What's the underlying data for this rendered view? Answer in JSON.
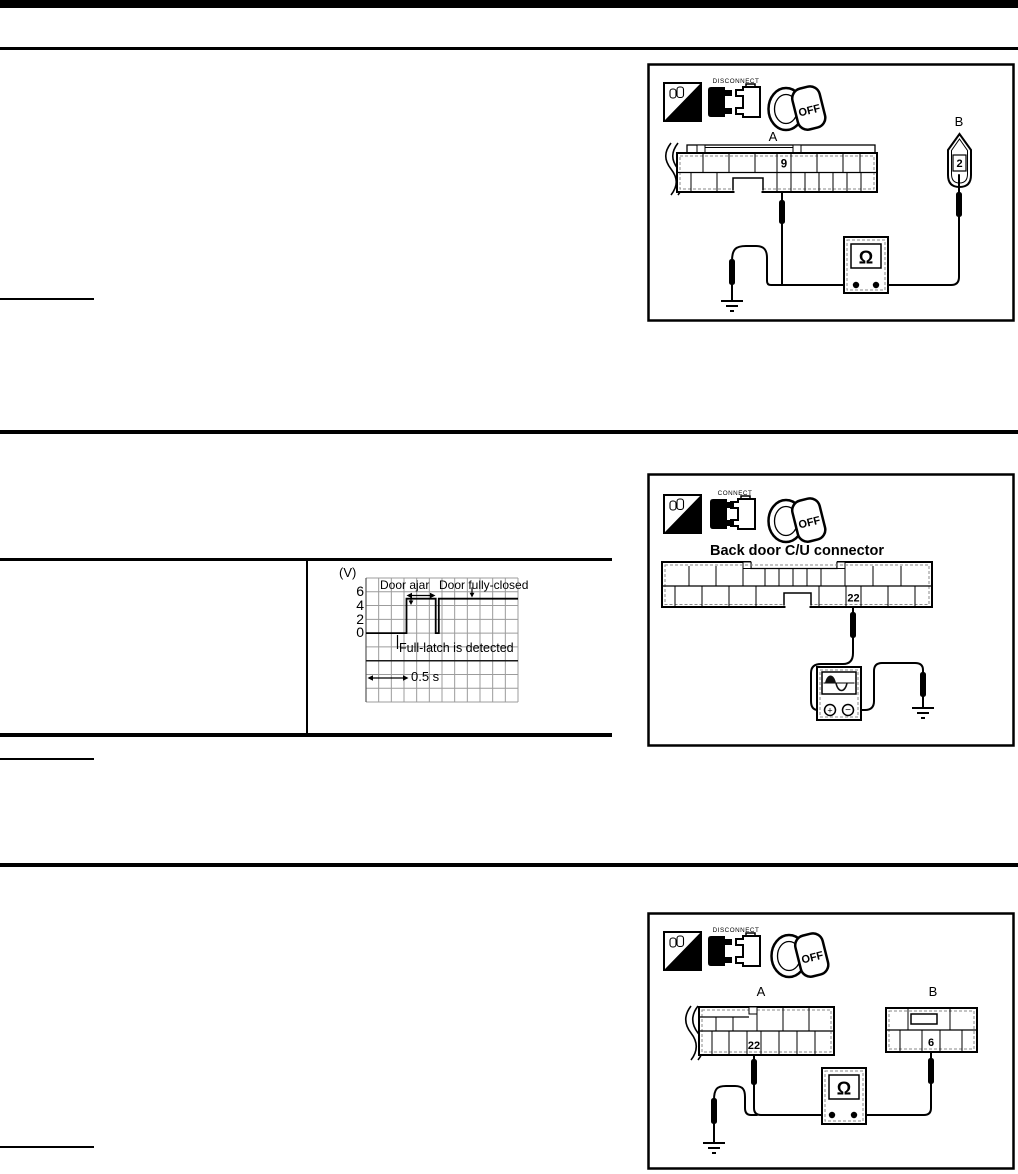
{
  "page": {
    "background": "#ffffff",
    "ink": "#000000",
    "dashed_inner_gray": "#8a8a8a",
    "grid_gray": "#9c9c9c"
  },
  "diagram_boxes": {
    "box1": {
      "hs_icon_label": "H.S.",
      "connector_state_label": "DISCONNECT",
      "ignition_key_label": "OFF",
      "connector_a_label": "A",
      "connector_a_pin": "9",
      "connector_b_label": "B",
      "connector_b_pin": "2",
      "meter_symbol": "Ω"
    },
    "box2": {
      "hs_icon_label": "H.S.",
      "connector_state_label": "CONNECT",
      "ignition_key_label": "OFF",
      "connector_title": "Back door C/U connector",
      "connector_pin": "22",
      "meter_terminal_plus": "+",
      "meter_terminal_minus": "−"
    },
    "box3": {
      "hs_icon_label": "H.S.",
      "connector_state_label": "DISCONNECT",
      "ignition_key_label": "OFF",
      "connector_a_label": "A",
      "connector_a_pin": "22",
      "connector_b_label": "B",
      "connector_b_pin": "6",
      "meter_symbol": "Ω"
    }
  },
  "chart_data": {
    "type": "line",
    "y_axis_unit_label": "(V)",
    "y_ticks": [
      "6",
      "4",
      "2",
      "0"
    ],
    "ylim": [
      0,
      6
    ],
    "grid": {
      "visible": true,
      "columns": 12,
      "rows": 9
    },
    "time_division_label": "0.5 s",
    "time_per_division_seconds": 0.5,
    "annotations": {
      "door_ajar": "Door ajar",
      "door_fully_closed": "Door fully-closed",
      "full_latch": "Full-latch is detected"
    },
    "series": [
      {
        "name": "back-door-switch-signal",
        "unit": "V",
        "points_t_v": [
          [
            0,
            0
          ],
          [
            3.2,
            0
          ],
          [
            3.2,
            5
          ],
          [
            5.5,
            5
          ],
          [
            5.5,
            0
          ],
          [
            5.75,
            0
          ],
          [
            5.75,
            5
          ],
          [
            12,
            5
          ]
        ]
      }
    ]
  }
}
